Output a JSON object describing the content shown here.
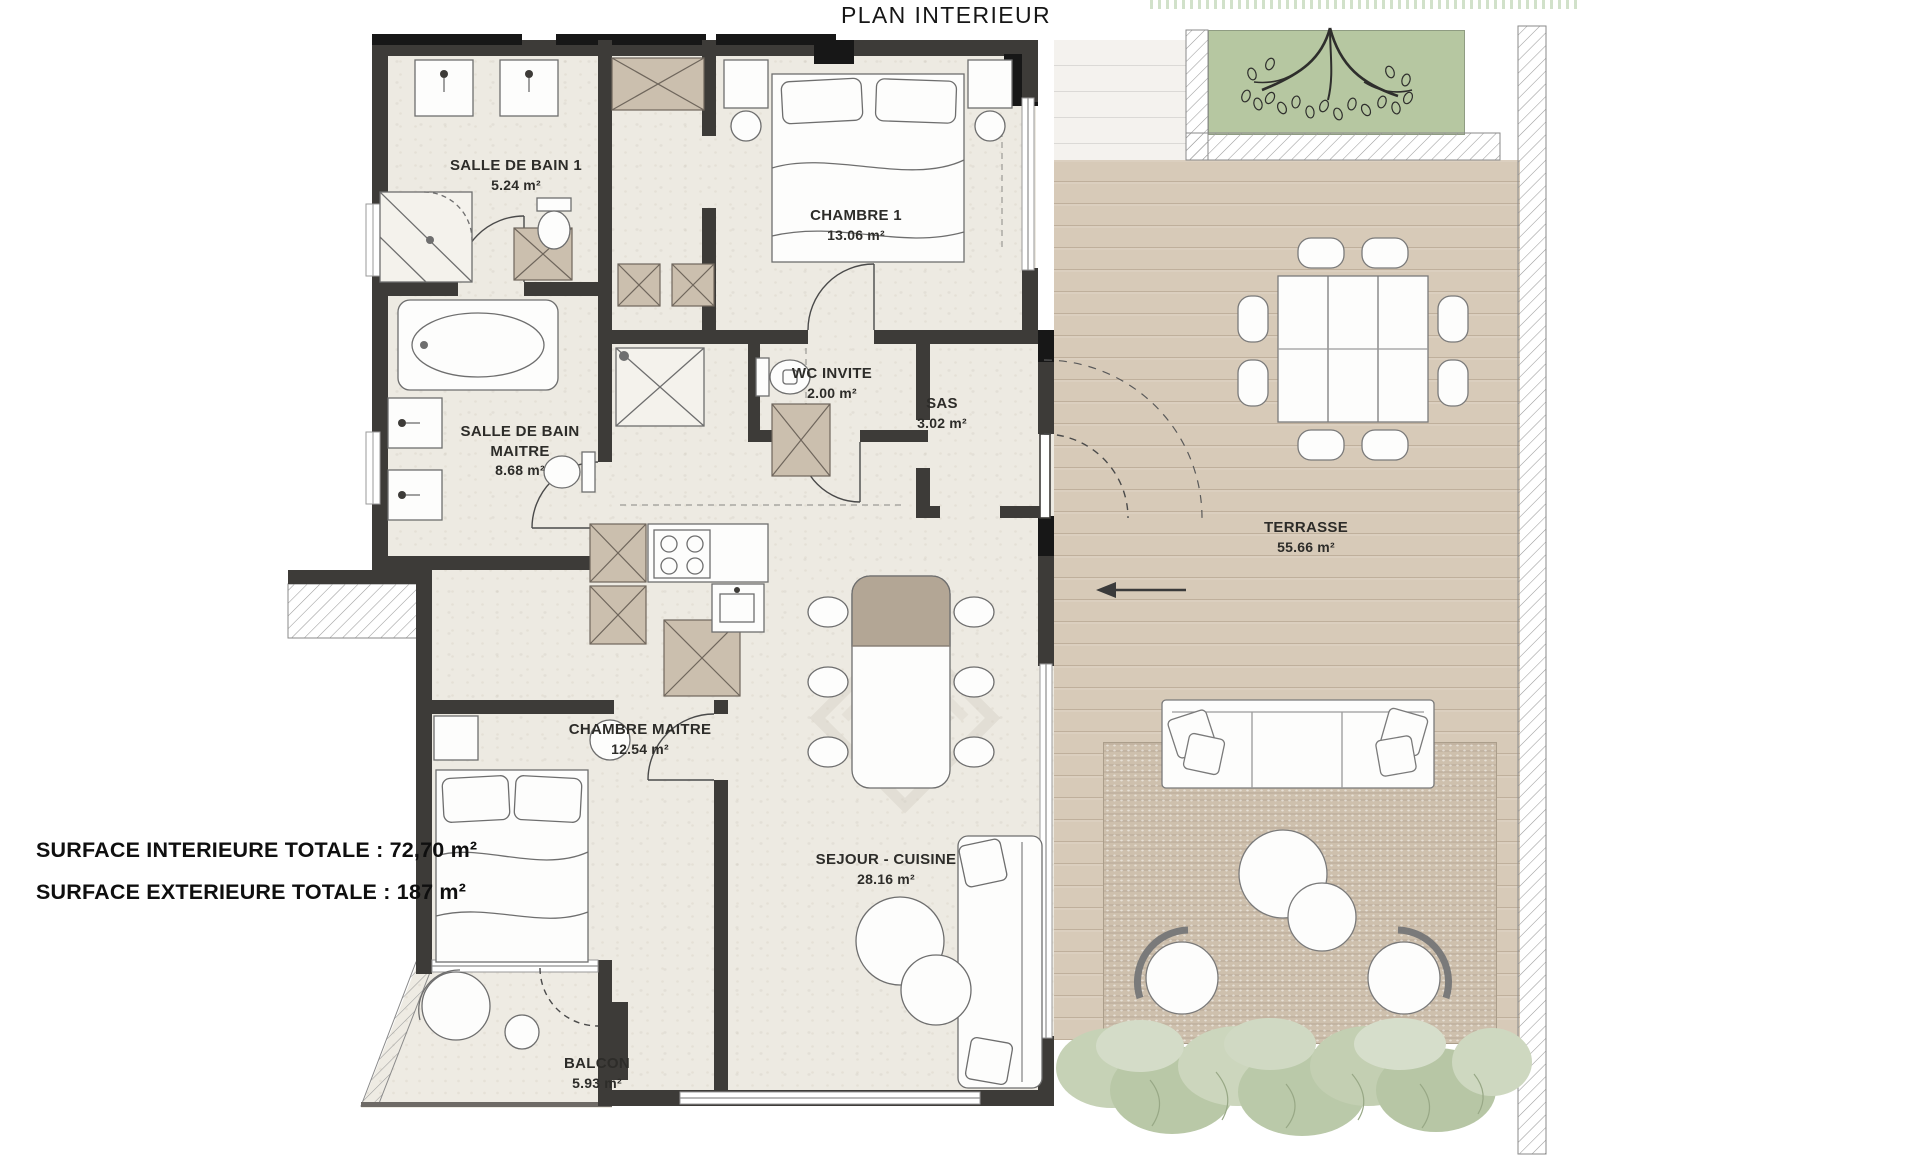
{
  "title": "PLAN INTERIEUR",
  "rooms": [
    {
      "id": "salle-de-bain-1",
      "name": "SALLE DE BAIN 1",
      "area": "5.24 m²"
    },
    {
      "id": "chambre-1",
      "name": "CHAMBRE 1",
      "area": "13.06 m²"
    },
    {
      "id": "wc-invite",
      "name": "WC INVITE",
      "area": "2.00 m²"
    },
    {
      "id": "sas",
      "name": "SAS",
      "area": "3.02 m²"
    },
    {
      "id": "salle-de-bain-maitre",
      "name": "SALLE DE BAIN MAITRE",
      "area": "8.68 m²"
    },
    {
      "id": "chambre-maitre",
      "name": "CHAMBRE MAITRE",
      "area": "12.54 m²"
    },
    {
      "id": "sejour-cuisine",
      "name": "SEJOUR - CUISINE",
      "area": "28.16 m²"
    },
    {
      "id": "balcon",
      "name": "BALCON",
      "area": "5.93 m²"
    },
    {
      "id": "terrasse",
      "name": "TERRASSE",
      "area": "55.66 m²"
    }
  ],
  "totals": {
    "interior": "SURFACE INTERIEURE TOTALE : 72,70 m²",
    "exterior": "SURFACE EXTERIEURE TOTALE : 187 m²"
  },
  "palette": {
    "wall": "#3d3b38",
    "wall_dark": "#171717",
    "floor": "#edeae2",
    "deck_wood": "#d7cab8",
    "garden_green": "#b6c7a1",
    "rug": "#cec0ad",
    "foliage": "#c2cfb2",
    "hatch_line": "#9b9b9b",
    "label_text": "#2d2c29"
  }
}
